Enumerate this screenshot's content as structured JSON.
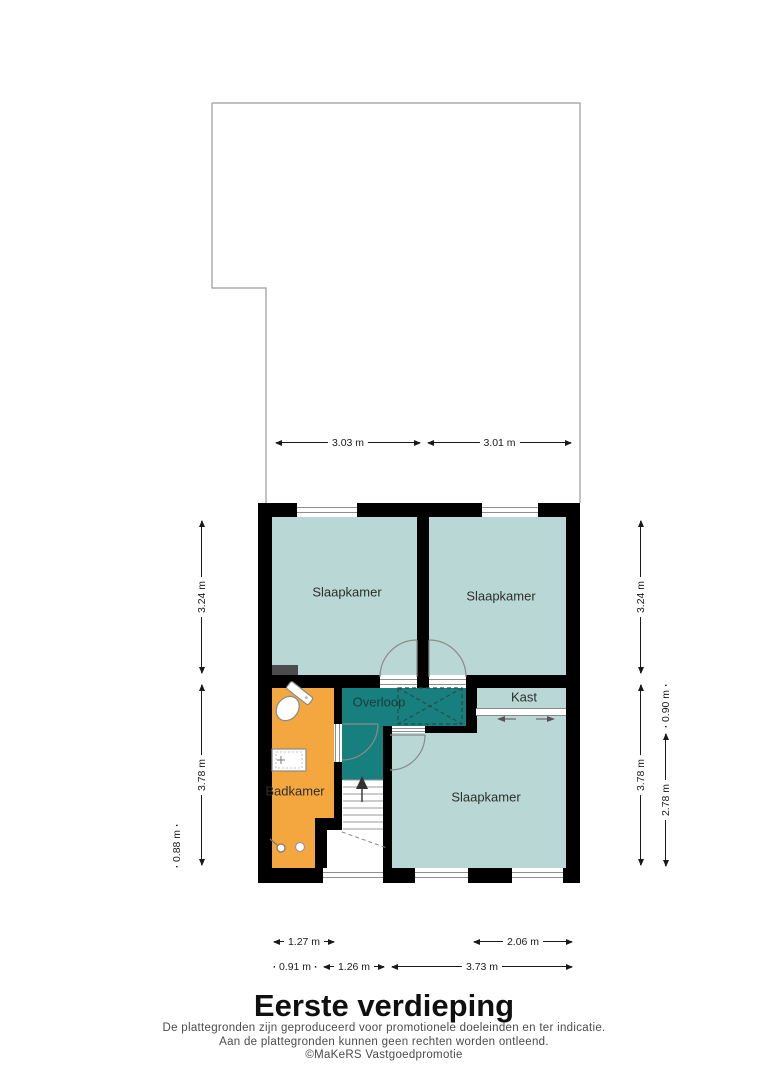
{
  "title": "Eerste verdieping",
  "disclaimer": {
    "line1": "De plattegronden zijn geproduceerd voor promotionele doeleinden en ter indicatie.",
    "line2": "Aan de plattegronden kunnen geen rechten worden ontleend.",
    "line3": "©MaKeRS Vastgoedpromotie"
  },
  "rooms": {
    "bedroom_top_left": "Slaapkamer",
    "bedroom_top_right": "Slaapkamer",
    "bedroom_bottom": "Slaapkamer",
    "landing": "Overloop",
    "closet": "Kast",
    "bathroom": "Badkamer"
  },
  "dimensions": {
    "top": [
      "3.03 m",
      "3.01 m"
    ],
    "left": [
      "3.24 m",
      "3.78 m",
      "0.88 m"
    ],
    "right": [
      "3.24 m",
      "0.90 m",
      "3.78 m",
      "2.78 m"
    ],
    "bottom_upper": [
      "1.27 m",
      "2.06 m"
    ],
    "bottom_lower": [
      "0.91 m",
      "1.26 m",
      "3.73 m"
    ]
  },
  "colors": {
    "wall": "#000000",
    "room_fill": "#b9d8d5",
    "landing_fill": "#17807e",
    "bathroom_fill": "#f4a73e"
  }
}
